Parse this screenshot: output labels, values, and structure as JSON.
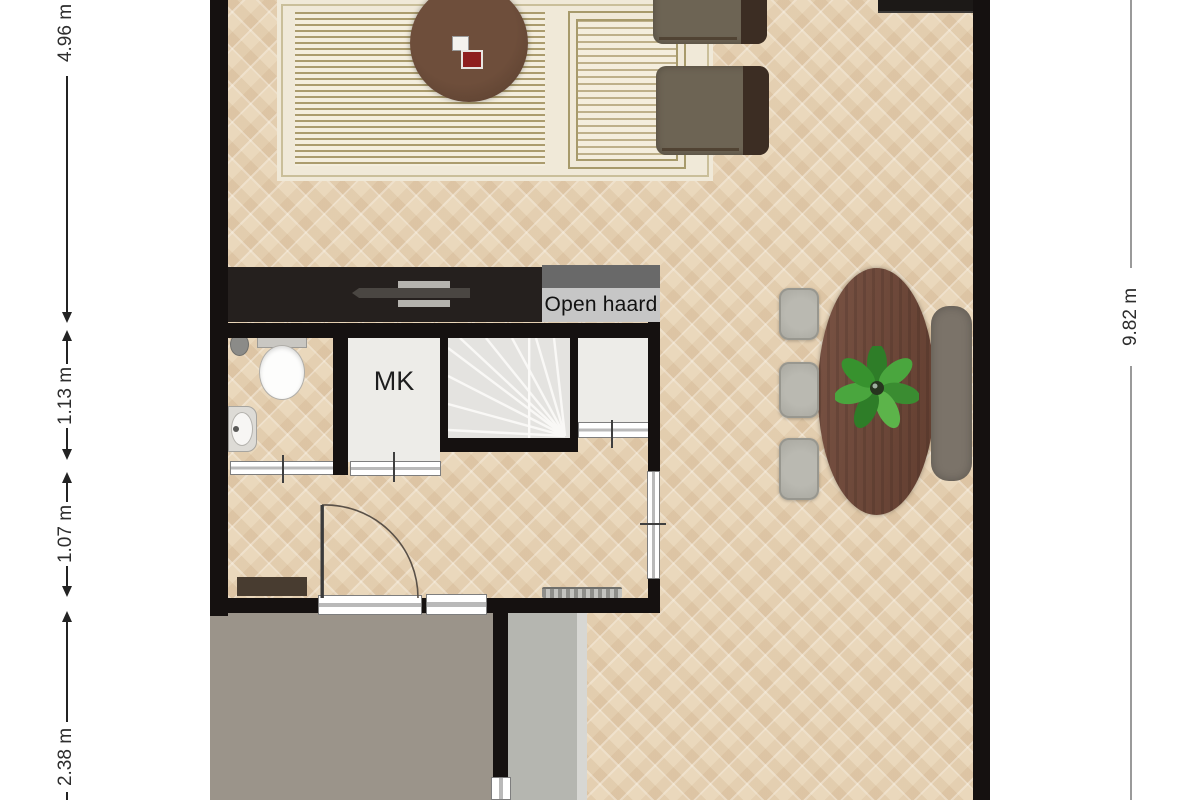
{
  "floorplan": {
    "title": "ground-floor-plan",
    "labels": {
      "meter_cupboard": "MK",
      "fireplace": "Open haard"
    },
    "dimensions": {
      "left": [
        {
          "value": "4.96 m"
        },
        {
          "value": "1.13 m"
        },
        {
          "value": "1.07 m"
        },
        {
          "value": "2.38 m"
        }
      ],
      "right": [
        {
          "value": "9.82 m"
        }
      ]
    },
    "colors": {
      "wall": "#151110",
      "floor_parquet": "#e9d7bc",
      "terrace": "#9b948a",
      "path": "#b5b6b0",
      "stairs": "#e4e3e0",
      "closet_interior": "#edece8",
      "fireplace_top": "#696969",
      "fireplace_label_bg": "#c6c6c6",
      "tv_unit": "#25201e",
      "dining_table_wood": "#6f4636",
      "dining_chair": "#a7a69e",
      "bench": "#7b7369",
      "armchair": "#6d6454",
      "plant_green": "#3f8f2f",
      "rug_background": "#f0e9d8",
      "rug_pattern": "#a3945f"
    }
  }
}
